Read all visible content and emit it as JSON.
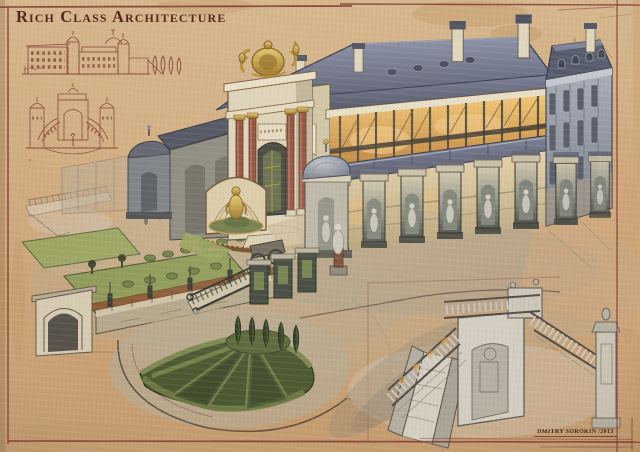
{
  "artwork": {
    "title": "Rich Class Architecture",
    "signature": "Dmitry Sorokin /2013"
  },
  "palette": {
    "paper": "#cfa87d",
    "frame_ink": "#7c3328",
    "title_text": "#5a2720",
    "sepia_sketch_ink": "#7b382b",
    "roof_slate": "#636a80",
    "wall_cream": "#ddd3b8",
    "gallery_glow": "#e0a04e",
    "stone_gray": "#9aa1ac",
    "pier_dark": "#53594f",
    "gold": "#c7a145",
    "marble_red": "#8e4a38",
    "lawn_green": "#8d9a58",
    "hedge_green": "#4a5730",
    "graphite_sketch": "#6b665c"
  },
  "scene": {
    "sketches": [
      "palace-facade-elevation",
      "entrance-gate-elevation",
      "grand-staircase-detail"
    ],
    "main_subjects": [
      "baroque-palace",
      "glass-gallery",
      "statue-colonnade",
      "entrance-gate",
      "golden-statue-fountain",
      "domed-turrets",
      "formal-lawns",
      "fan-hedge-parterre",
      "cypress-trees",
      "garden-balustrade-wall",
      "arched-garden-bridge",
      "garden-staircase",
      "esplanade"
    ]
  }
}
